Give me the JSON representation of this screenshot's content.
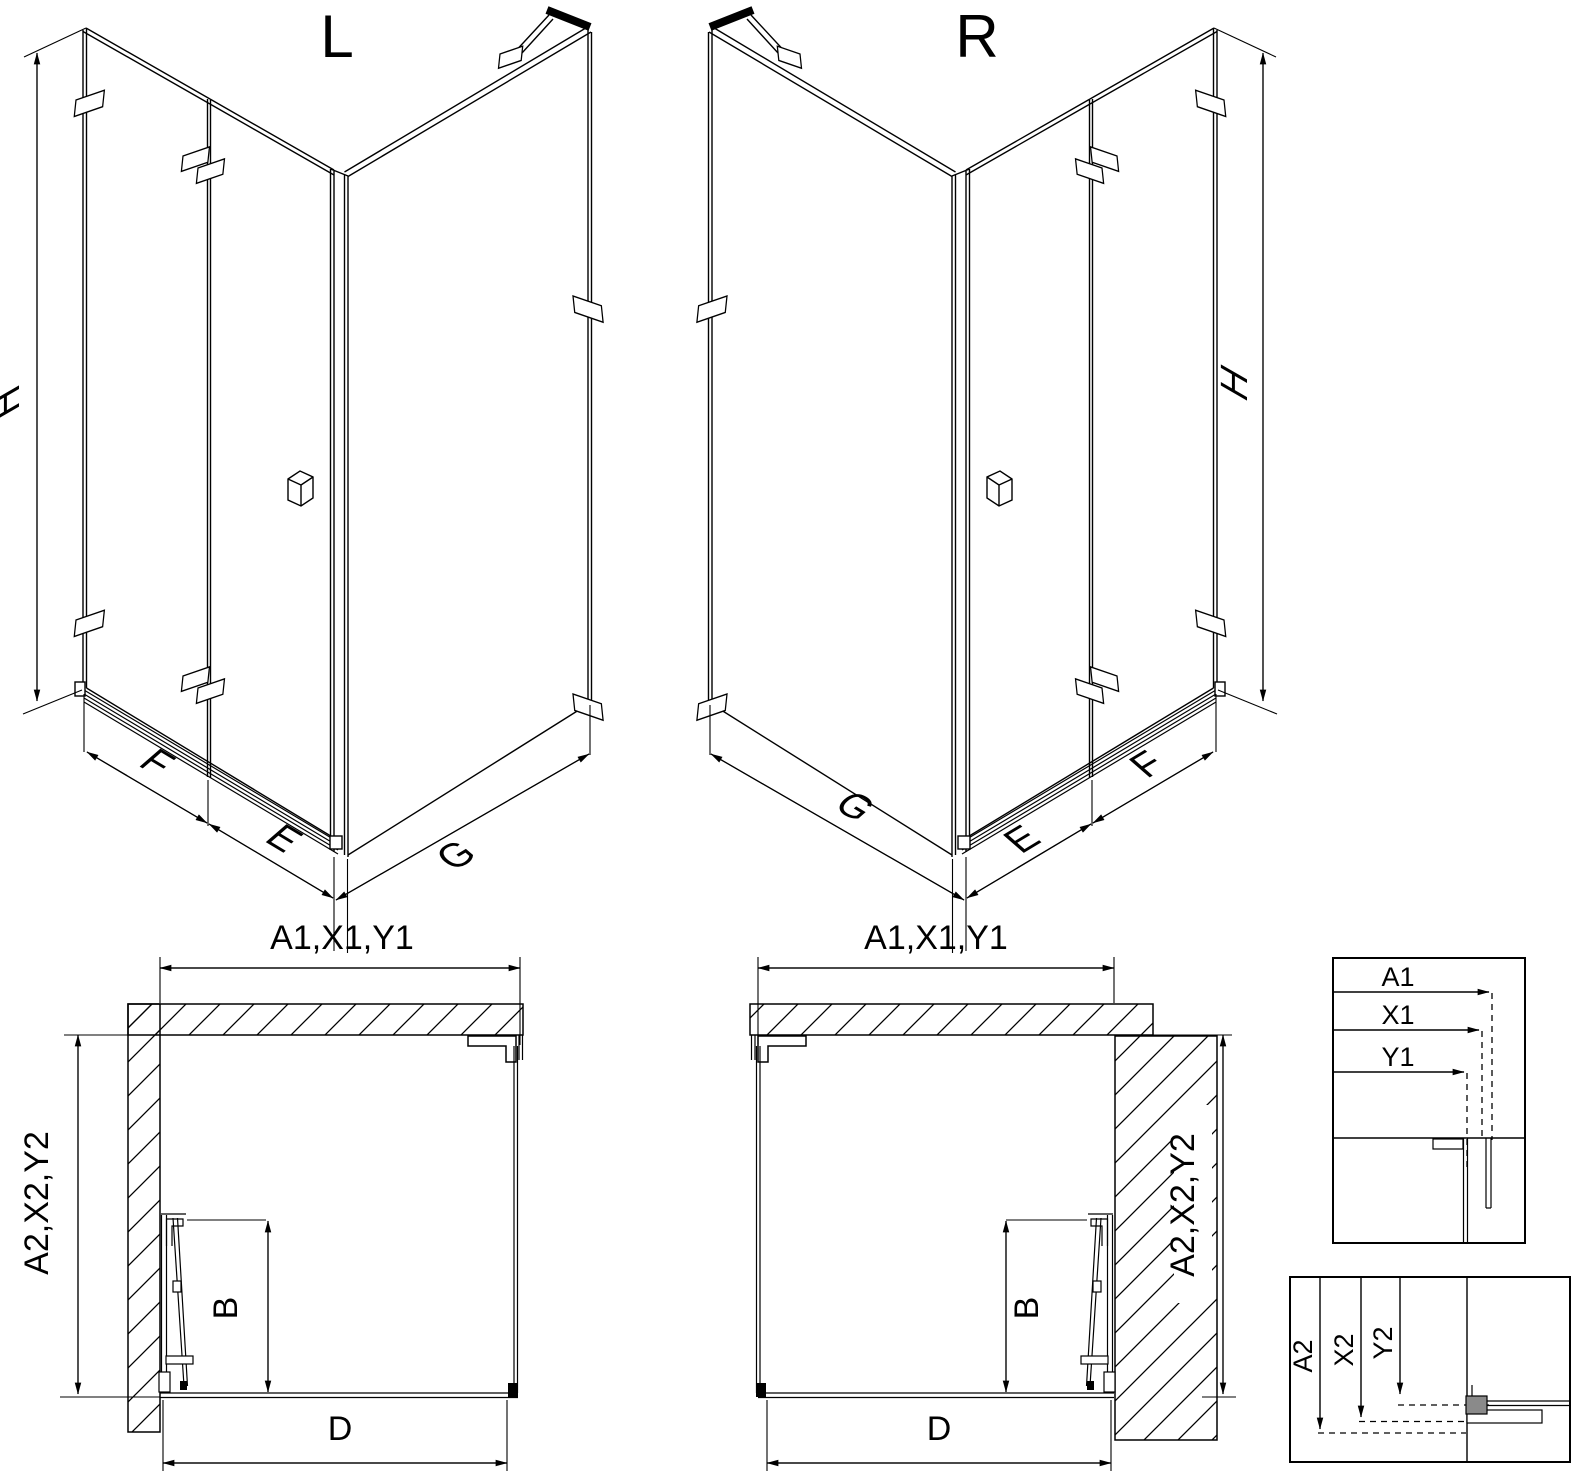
{
  "drawing": {
    "views": {
      "iso_left": {
        "title": "L",
        "dim_h": "H",
        "dim_f": "F",
        "dim_e": "E",
        "dim_g": "G"
      },
      "iso_right": {
        "title": "R",
        "dim_h": "H",
        "dim_f": "F",
        "dim_e": "E",
        "dim_g": "G"
      },
      "plan_left": {
        "dim_width": "A1,X1,Y1",
        "dim_depth": "A2,X2,Y2",
        "dim_door": "B",
        "dim_entry": "D"
      },
      "plan_right": {
        "dim_width": "A1,X1,Y1",
        "dim_depth": "A2,X2,Y2",
        "dim_door": "B",
        "dim_entry": "D"
      },
      "detail_width": {
        "dim_a1": "A1",
        "dim_x1": "X1",
        "dim_y1": "Y1"
      },
      "detail_depth": {
        "dim_a2": "A2",
        "dim_x2": "X2",
        "dim_y2": "Y2"
      }
    },
    "colors": {
      "line": "#000000",
      "background": "#ffffff"
    }
  }
}
